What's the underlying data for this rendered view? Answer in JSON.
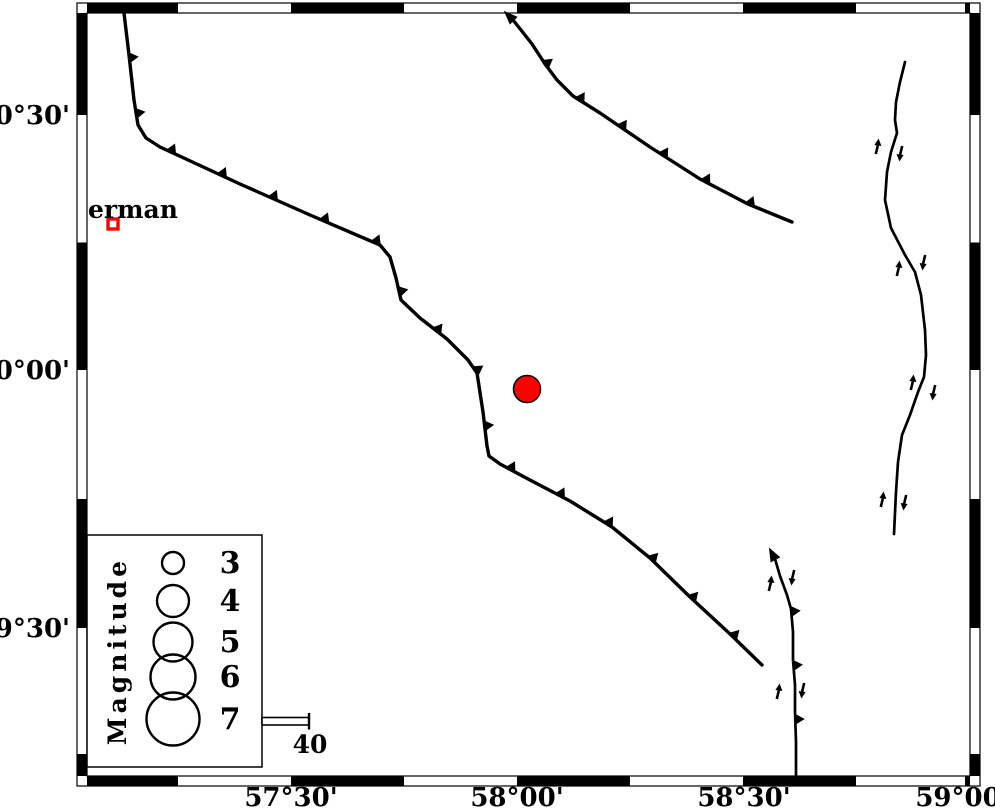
{
  "map": {
    "background": "#ffffff",
    "ink": "#000000",
    "accent_red": "#ff0000",
    "frame": {
      "outer": {
        "x1": 77,
        "y1": 3,
        "x2": 980,
        "y2": 786
      },
      "inner": {
        "x1": 87,
        "y1": 13,
        "x2": 970,
        "y2": 776
      },
      "lon_boundaries": [
        178,
        291,
        404,
        517,
        630,
        743,
        856,
        965
      ],
      "lat_boundaries": [
        115,
        242.5,
        370,
        499,
        628,
        754
      ]
    },
    "axis": {
      "lat_labels": [
        {
          "text": "30°30'",
          "y": 115
        },
        {
          "text": "30°00'",
          "y": 370
        },
        {
          "text": "29°30'",
          "y": 628
        }
      ],
      "lon_labels": [
        {
          "text": "57°30'",
          "x": 291
        },
        {
          "text": "58°00'",
          "x": 517
        },
        {
          "text": "58°30'",
          "x": 744
        },
        {
          "text": "59°00'",
          "x": 962
        }
      ]
    },
    "city": {
      "label": "erman",
      "label_x": 88,
      "label_y": 218,
      "marker": {
        "x": 113,
        "y": 224,
        "size": 10,
        "border": 3.4,
        "color": "#ff0000"
      }
    },
    "epicenter": {
      "x": 527,
      "y": 389,
      "r": 13.5,
      "fill": "#ff0000",
      "outline": "#000000"
    },
    "faults": [
      {
        "name": "thrust-fault-northwest",
        "width": 3.4,
        "teeth_spacing": 56,
        "teeth_offset": 45,
        "points": [
          [
            124,
            13
          ],
          [
            129,
            55
          ],
          [
            134,
            100
          ],
          [
            138,
            125
          ],
          [
            146,
            138
          ],
          [
            160,
            147
          ],
          [
            240,
            184
          ],
          [
            310,
            215
          ],
          [
            380,
            245
          ],
          [
            390,
            257
          ],
          [
            396,
            278
          ],
          [
            401,
            300
          ],
          [
            420,
            318
          ],
          [
            447,
            339
          ],
          [
            468,
            360
          ],
          [
            477,
            373
          ],
          [
            483,
            412
          ],
          [
            487,
            446
          ],
          [
            489,
            456
          ],
          [
            500,
            464
          ],
          [
            530,
            480
          ],
          [
            570,
            501
          ],
          [
            612,
            527
          ],
          [
            650,
            558
          ],
          [
            690,
            597
          ],
          [
            729,
            633
          ],
          [
            762,
            665
          ]
        ]
      },
      {
        "name": "thrust-fault-north",
        "width": 3.4,
        "teeth_spacing": 50,
        "teeth_offset": 55,
        "start_arrow_deg": -135,
        "points": [
          [
            513,
            20
          ],
          [
            521,
            30
          ],
          [
            532,
            44
          ],
          [
            545,
            64
          ],
          [
            557,
            80
          ],
          [
            573,
            96
          ],
          [
            600,
            113
          ],
          [
            650,
            147
          ],
          [
            700,
            179
          ],
          [
            748,
            204
          ],
          [
            792,
            222
          ]
        ]
      },
      {
        "name": "oblique-fault-southeast",
        "width": 2.7,
        "teeth_spacing": 54,
        "teeth_offset": 55,
        "start_arrow_deg": -118,
        "points": [
          [
            775,
            559
          ],
          [
            780,
            576
          ],
          [
            787,
            595
          ],
          [
            791,
            609
          ],
          [
            793,
            632
          ],
          [
            793,
            660
          ],
          [
            795,
            685
          ],
          [
            795,
            712
          ],
          [
            796,
            742
          ],
          [
            796,
            775
          ]
        ]
      },
      {
        "name": "strike-slip-fault-east",
        "width": 2.7,
        "teeth_spacing": 0,
        "points": [
          [
            905,
            62
          ],
          [
            900,
            82
          ],
          [
            896,
            102
          ],
          [
            895,
            120
          ],
          [
            897,
            133
          ],
          [
            891,
            152
          ],
          [
            887,
            172
          ],
          [
            885,
            200
          ],
          [
            891,
            228
          ],
          [
            905,
            255
          ],
          [
            915,
            272
          ],
          [
            921,
            295
          ],
          [
            925,
            330
          ],
          [
            926,
            355
          ],
          [
            924,
            377
          ],
          [
            918,
            392
          ],
          [
            910,
            415
          ],
          [
            902,
            435
          ],
          [
            898,
            462
          ],
          [
            896,
            492
          ],
          [
            894,
            534
          ]
        ]
      }
    ],
    "slip_arrows": [
      {
        "x": 877,
        "y": 147,
        "dir": "up"
      },
      {
        "x": 901,
        "y": 153,
        "dir": "down"
      },
      {
        "x": 898,
        "y": 269,
        "dir": "up"
      },
      {
        "x": 924,
        "y": 262,
        "dir": "down"
      },
      {
        "x": 912,
        "y": 383,
        "dir": "up"
      },
      {
        "x": 934,
        "y": 392,
        "dir": "down"
      },
      {
        "x": 882,
        "y": 500,
        "dir": "up"
      },
      {
        "x": 905,
        "y": 502,
        "dir": "down"
      },
      {
        "x": 770,
        "y": 584,
        "dir": "up"
      },
      {
        "x": 793,
        "y": 577,
        "dir": "down"
      },
      {
        "x": 778,
        "y": 692,
        "dir": "up"
      },
      {
        "x": 803,
        "y": 690,
        "dir": "down"
      }
    ]
  },
  "legend": {
    "box": {
      "x1": 87,
      "y1": 535,
      "x2": 262,
      "y2": 767
    },
    "title": "Magnitude",
    "title_x": 126,
    "title_y": 651,
    "circle_cx": 173,
    "label_cx": 230,
    "entries": [
      {
        "label": "3",
        "cy": 563,
        "r": 11
      },
      {
        "label": "4",
        "cy": 601,
        "r": 16
      },
      {
        "label": "5",
        "cy": 642,
        "r": 19.5
      },
      {
        "label": "6",
        "cy": 677,
        "r": 22.5
      },
      {
        "label": "7",
        "cy": 719,
        "r": 26.5
      }
    ]
  },
  "scalebar": {
    "x1": 262,
    "x2": 309,
    "y": 717.5,
    "h": 7.5,
    "label": "40",
    "label_x": 310,
    "label_y": 753
  }
}
